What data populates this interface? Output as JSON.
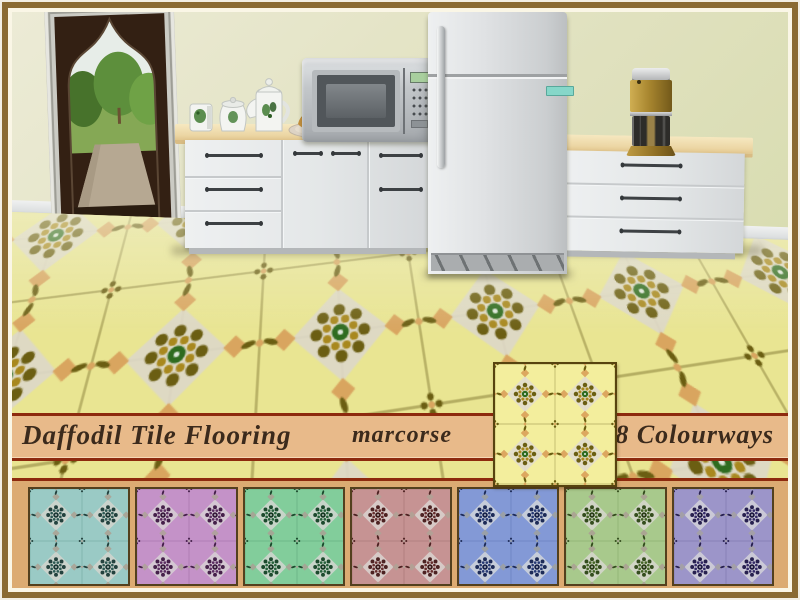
{
  "banner": {
    "title": "Daffodil Tile Flooring",
    "author": "marcorse",
    "colourways_label": "8 Colourways",
    "background": "#e8ba8a",
    "line_color": "#8d2a0e",
    "text_color": "#3b2a1c"
  },
  "band": {
    "background": "#dcab72"
  },
  "frame": {
    "border_color": "#8a6b33",
    "inner_line_color": "#faf6e6"
  },
  "scene": {
    "wall_color": "#e3e3c4",
    "objects": [
      "arched-garden-window",
      "kitchen-counters",
      "tea-set",
      "bread-plate",
      "microwave",
      "refrigerator",
      "coffee-maker",
      "daffodil-tile-floor"
    ]
  },
  "floor_pattern": {
    "base": "#e9e592",
    "grout": "#b5ae62",
    "diamond": "#ded8c8",
    "dark": "#6b5e12",
    "gold": "#a8881e",
    "center": "#2e6b1f",
    "accent": "#d9a55f"
  },
  "colorways": [
    {
      "name": "daffodil-yellow",
      "featured": true,
      "colors": {
        "base": "#f3ee9d",
        "grout": "#c2bb6e",
        "diamond": "#e3ddcd",
        "dark": "#6b5e12",
        "gold": "#a8881e",
        "center": "#2e6b1f",
        "accent": "#dca75f"
      }
    },
    {
      "name": "teal",
      "featured": false,
      "colors": {
        "base": "#9acac5",
        "grout": "#7cb0aa",
        "diamond": "#cfd4cd",
        "dark": "#23423e",
        "gold": "#2e5a54",
        "center": "#1d3a36",
        "accent": "#a9a79a"
      }
    },
    {
      "name": "orchid",
      "featured": false,
      "colors": {
        "base": "#c492c8",
        "grout": "#aa79b0",
        "diamond": "#d6ccd4",
        "dark": "#45204a",
        "gold": "#5d2f63",
        "center": "#381b3c",
        "accent": "#b1a09f"
      }
    },
    {
      "name": "mint",
      "featured": false,
      "colors": {
        "base": "#82cd9b",
        "grout": "#68b383",
        "diamond": "#cdd6cd",
        "dark": "#1c4a2d",
        "gold": "#27633c",
        "center": "#163a23",
        "accent": "#a3a795"
      }
    },
    {
      "name": "rose",
      "featured": false,
      "colors": {
        "base": "#c69393",
        "grout": "#ad7a7a",
        "diamond": "#d8cfcb",
        "dark": "#4d2222",
        "gold": "#662e2e",
        "center": "#3d1b1b",
        "accent": "#b3a095"
      }
    },
    {
      "name": "periwinkle",
      "featured": false,
      "colors": {
        "base": "#8399d6",
        "grout": "#6a82c0",
        "diamond": "#ccd2da",
        "dark": "#1d2b58",
        "gold": "#273a74",
        "center": "#17224a",
        "accent": "#9aa0a8"
      }
    },
    {
      "name": "sage",
      "featured": false,
      "colors": {
        "base": "#a8c98c",
        "grout": "#8fb172",
        "diamond": "#d4d6ca",
        "dark": "#344d1d",
        "gold": "#456627",
        "center": "#2a3d17",
        "accent": "#aaa592"
      }
    },
    {
      "name": "violet",
      "featured": false,
      "colors": {
        "base": "#9c95c9",
        "grout": "#827bb3",
        "diamond": "#d0cdd8",
        "dark": "#27204f",
        "gold": "#352b68",
        "center": "#1e1941",
        "accent": "#a39fa8"
      }
    }
  ]
}
